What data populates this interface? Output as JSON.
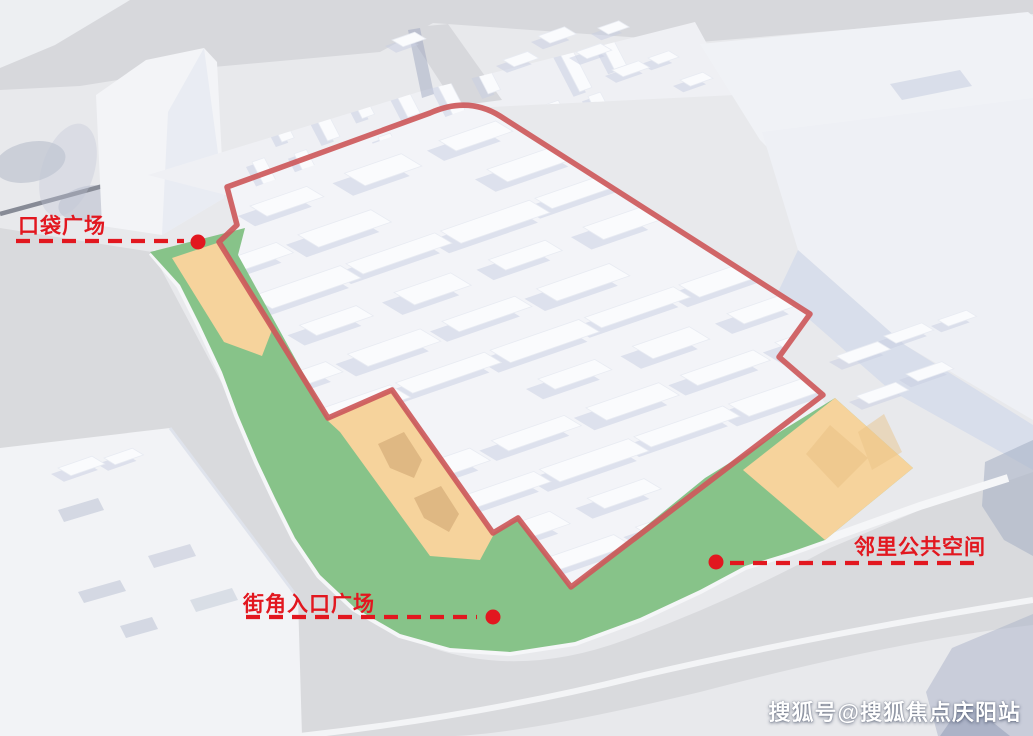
{
  "annotations": {
    "label_color": "#e2171f",
    "labels": [
      {
        "id": "pocket-plaza",
        "text": "口袋广场"
      },
      {
        "id": "corner-entrance-plaza",
        "text": "街角入口广场"
      },
      {
        "id": "neighborhood-public-space",
        "text": "邻里公共空间"
      }
    ]
  },
  "watermark": {
    "text": "搜狐号@搜狐焦点庆阳站"
  },
  "colors": {
    "boundary_red": "#cd595b",
    "label_red": "#e2171f",
    "green": "#87c389",
    "orange": "#f6d39c",
    "tan": "#dfb883",
    "watermark": "#ffffff"
  }
}
